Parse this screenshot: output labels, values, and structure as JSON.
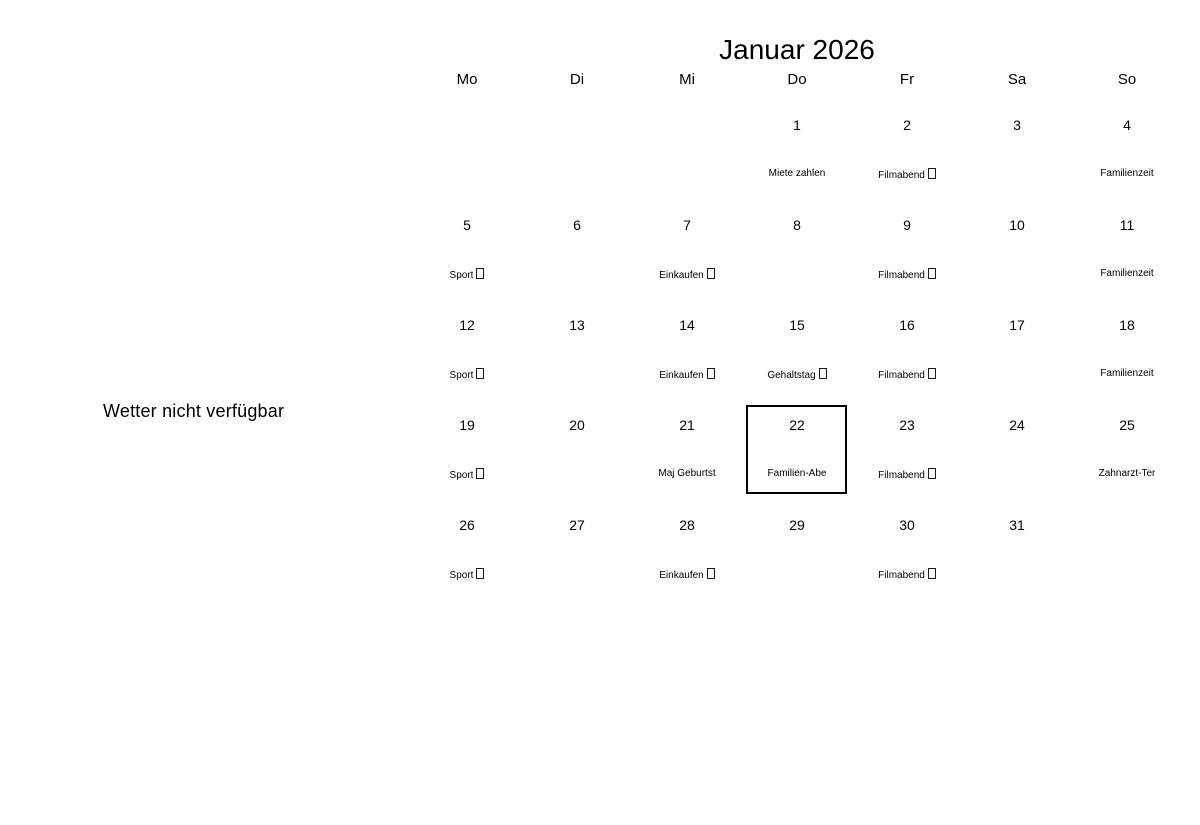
{
  "weather": {
    "note": "Wetter nicht verfügbar"
  },
  "calendar": {
    "title": "Januar 2026",
    "weekdays": [
      "Mo",
      "Di",
      "Mi",
      "Do",
      "Fr",
      "Sa",
      "So"
    ],
    "colors": {
      "text": "#000000",
      "background": "#ffffff",
      "selected_day_border": "#000000"
    },
    "selected_day": "22",
    "weeks": [
      [
        {
          "day": ""
        },
        {
          "day": ""
        },
        {
          "day": ""
        },
        {
          "day": "1",
          "event": "Miete zahlen",
          "missing_glyph": false
        },
        {
          "day": "2",
          "event": "Filmabend",
          "missing_glyph": true
        },
        {
          "day": "3"
        },
        {
          "day": "4",
          "event": "Familienzeit",
          "missing_glyph": false
        }
      ],
      [
        {
          "day": "5",
          "event": "Sport",
          "missing_glyph": true
        },
        {
          "day": "6"
        },
        {
          "day": "7",
          "event": "Einkaufen",
          "missing_glyph": true
        },
        {
          "day": "8"
        },
        {
          "day": "9",
          "event": "Filmabend",
          "missing_glyph": true
        },
        {
          "day": "10"
        },
        {
          "day": "11",
          "event": "Familienzeit",
          "missing_glyph": false
        }
      ],
      [
        {
          "day": "12",
          "event": "Sport",
          "missing_glyph": true
        },
        {
          "day": "13"
        },
        {
          "day": "14",
          "event": "Einkaufen",
          "missing_glyph": true
        },
        {
          "day": "15",
          "event": "Gehaltstag",
          "missing_glyph": true
        },
        {
          "day": "16",
          "event": "Filmabend",
          "missing_glyph": true
        },
        {
          "day": "17"
        },
        {
          "day": "18",
          "event": "Familienzeit",
          "missing_glyph": false
        }
      ],
      [
        {
          "day": "19",
          "event": "Sport",
          "missing_glyph": true
        },
        {
          "day": "20"
        },
        {
          "day": "21",
          "event": "Maj Geburtst",
          "missing_glyph": false
        },
        {
          "day": "22",
          "event": "Familien-Abe",
          "missing_glyph": false,
          "highlighted": true
        },
        {
          "day": "23",
          "event": "Filmabend",
          "missing_glyph": true
        },
        {
          "day": "24"
        },
        {
          "day": "25",
          "event": "Zahnarzt-Ter",
          "missing_glyph": false
        }
      ],
      [
        {
          "day": "26",
          "event": "Sport",
          "missing_glyph": true
        },
        {
          "day": "27"
        },
        {
          "day": "28",
          "event": "Einkaufen",
          "missing_glyph": true
        },
        {
          "day": "29"
        },
        {
          "day": "30",
          "event": "Filmabend",
          "missing_glyph": true
        },
        {
          "day": "31"
        },
        {
          "day": ""
        }
      ]
    ]
  }
}
